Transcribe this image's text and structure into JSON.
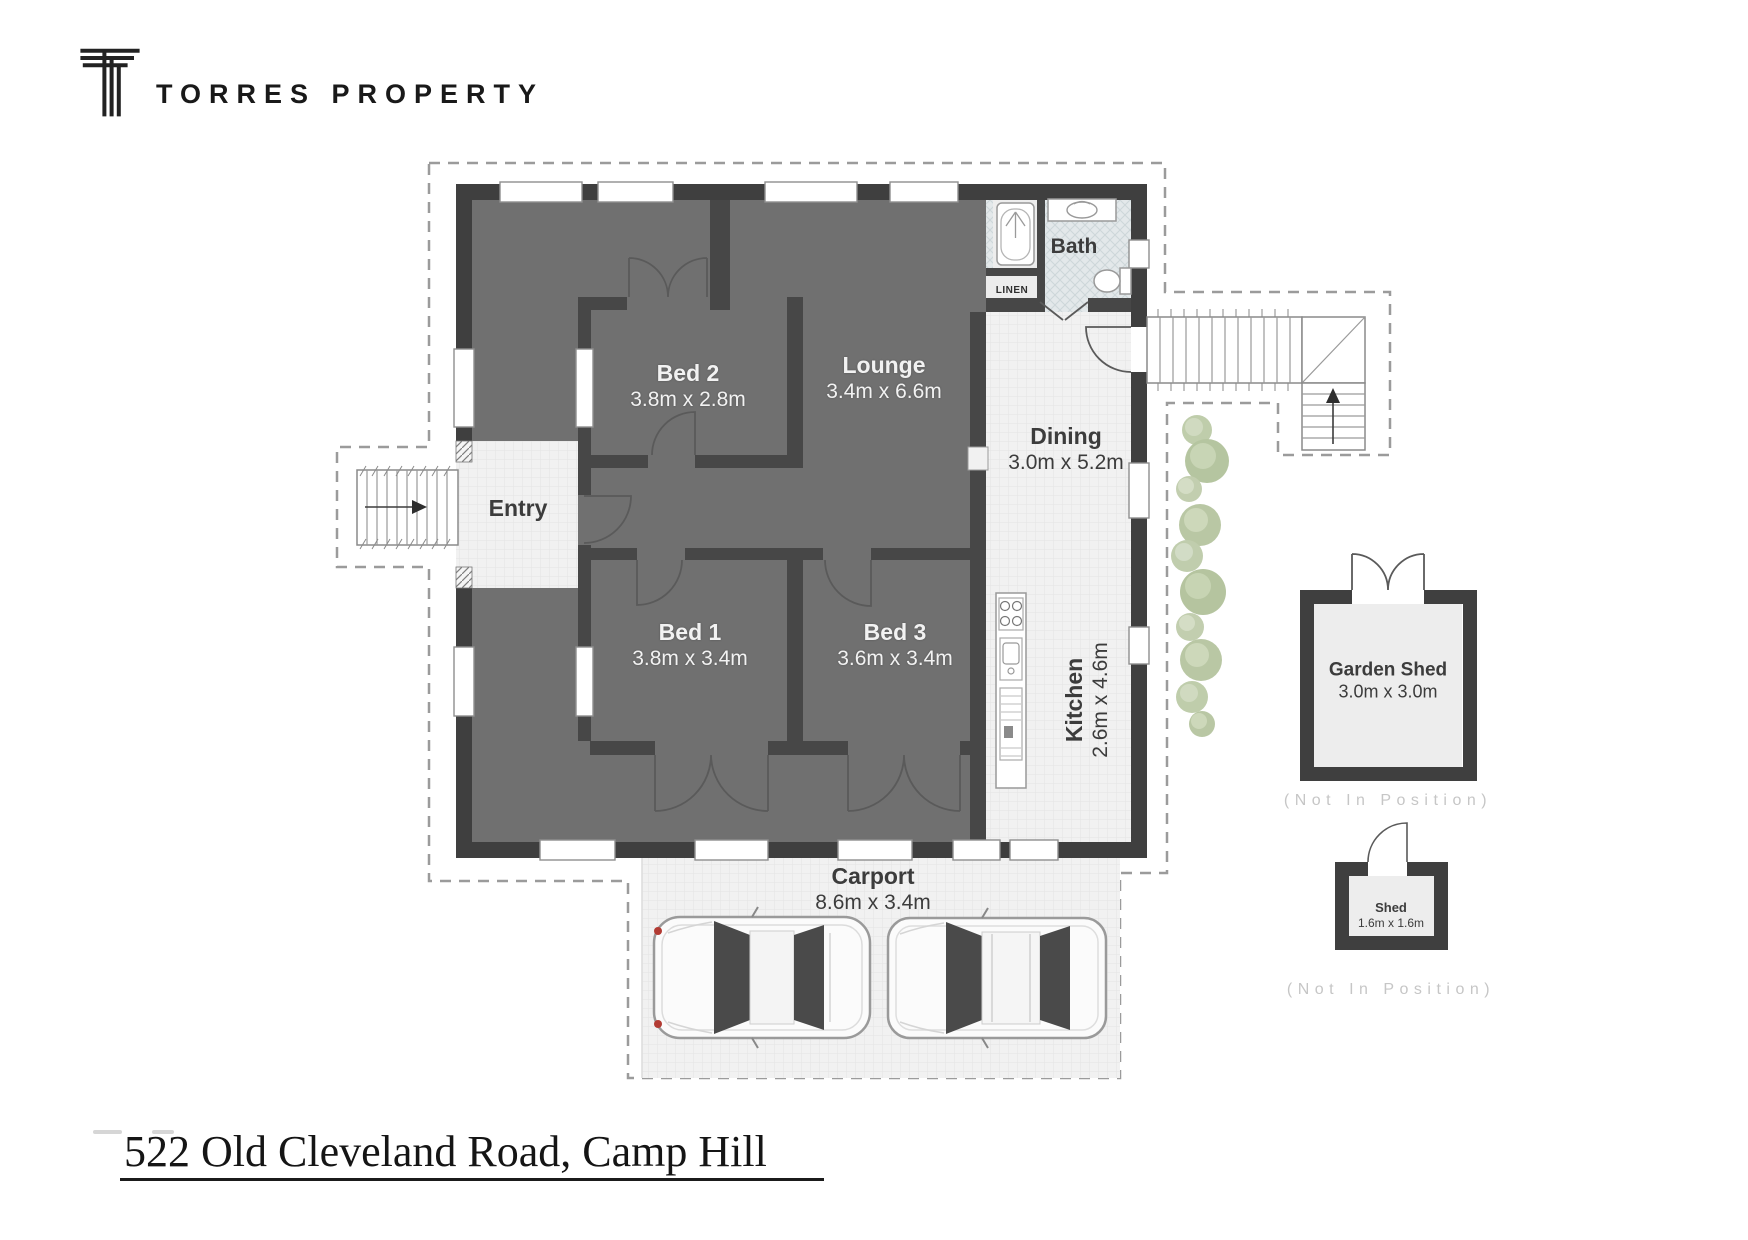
{
  "brand": {
    "name": "TORRES PROPERTY"
  },
  "address": {
    "text": "522 Old Cleveland Road, Camp Hill"
  },
  "plan": {
    "rooms": {
      "entry": {
        "name": "Entry"
      },
      "bed2": {
        "name": "Bed 2",
        "dims": "3.8m x 2.8m"
      },
      "lounge": {
        "name": "Lounge",
        "dims": "3.4m x 6.6m"
      },
      "bed1": {
        "name": "Bed 1",
        "dims": "3.8m x 3.4m"
      },
      "bed3": {
        "name": "Bed 3",
        "dims": "3.6m x 3.4m"
      },
      "dining": {
        "name": "Dining",
        "dims": "3.0m x 5.2m"
      },
      "kitchen": {
        "name": "Kitchen",
        "dims": "2.6m x 4.6m"
      },
      "bath": {
        "name": "Bath"
      },
      "linen": {
        "name": "LINEN"
      },
      "carport": {
        "name": "Carport",
        "dims": "8.6m x 3.4m"
      }
    },
    "outbuildings": {
      "garden_shed": {
        "name": "Garden Shed",
        "dims": "3.0m x 3.0m",
        "note": "(Not In Position)"
      },
      "shed": {
        "name": "Shed",
        "dims": "1.6m x 1.6m",
        "note": "(Not In Position)"
      }
    },
    "colors": {
      "wall": "#3f3f3f",
      "floor_dark": "#707070",
      "tile_light": "#f1f1f1",
      "bath_tile": "#e3e8ea",
      "plant_green": "#b9c8a3",
      "boundary_dash": "#9b9b9b",
      "label_light": "#f2f2f2",
      "label_dark": "#3c3c3c",
      "note_gray": "#c6c6c6",
      "tail_light_red": "#b23b33"
    }
  }
}
